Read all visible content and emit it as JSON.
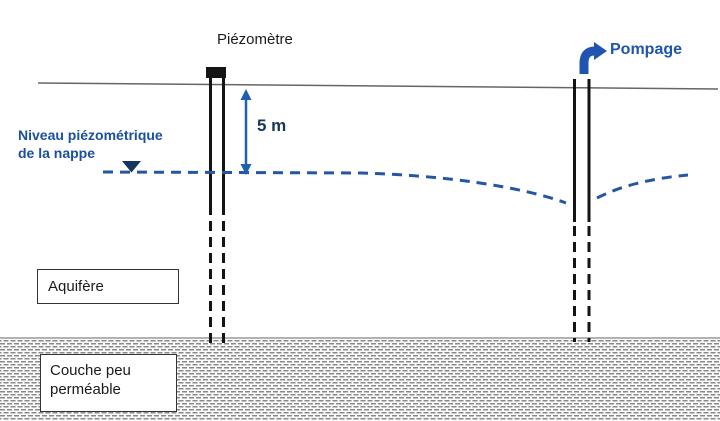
{
  "diagram": {
    "piezometer_label": "Piézomètre",
    "pumping_label": "Pompage",
    "water_table_label_line1": "Niveau piézométrique",
    "water_table_label_line2": "de la nappe",
    "depth_label": "5 m",
    "aquifer_label": "Aquifère",
    "confining_layer_label_line1": "Couche peu",
    "confining_layer_label_line2": "perméable"
  },
  "icons": {
    "water_table_marker": "down-triangle",
    "depth_arrow": "double-headed-vertical-arrow",
    "pump_flow_arrow": "elbow-up-right-arrow"
  },
  "colors": {
    "label_blue": "#1f55b0",
    "niveau_blue": "#1b4fa0",
    "depth_blue": "#17365d",
    "arrow_blue": "#2060b0",
    "water_line_blue": "#2456a4",
    "ground_gray": "#666666",
    "well_black": "#141414",
    "hatch_gray": "#8a8a8a",
    "layer_border_gray": "#999999"
  }
}
